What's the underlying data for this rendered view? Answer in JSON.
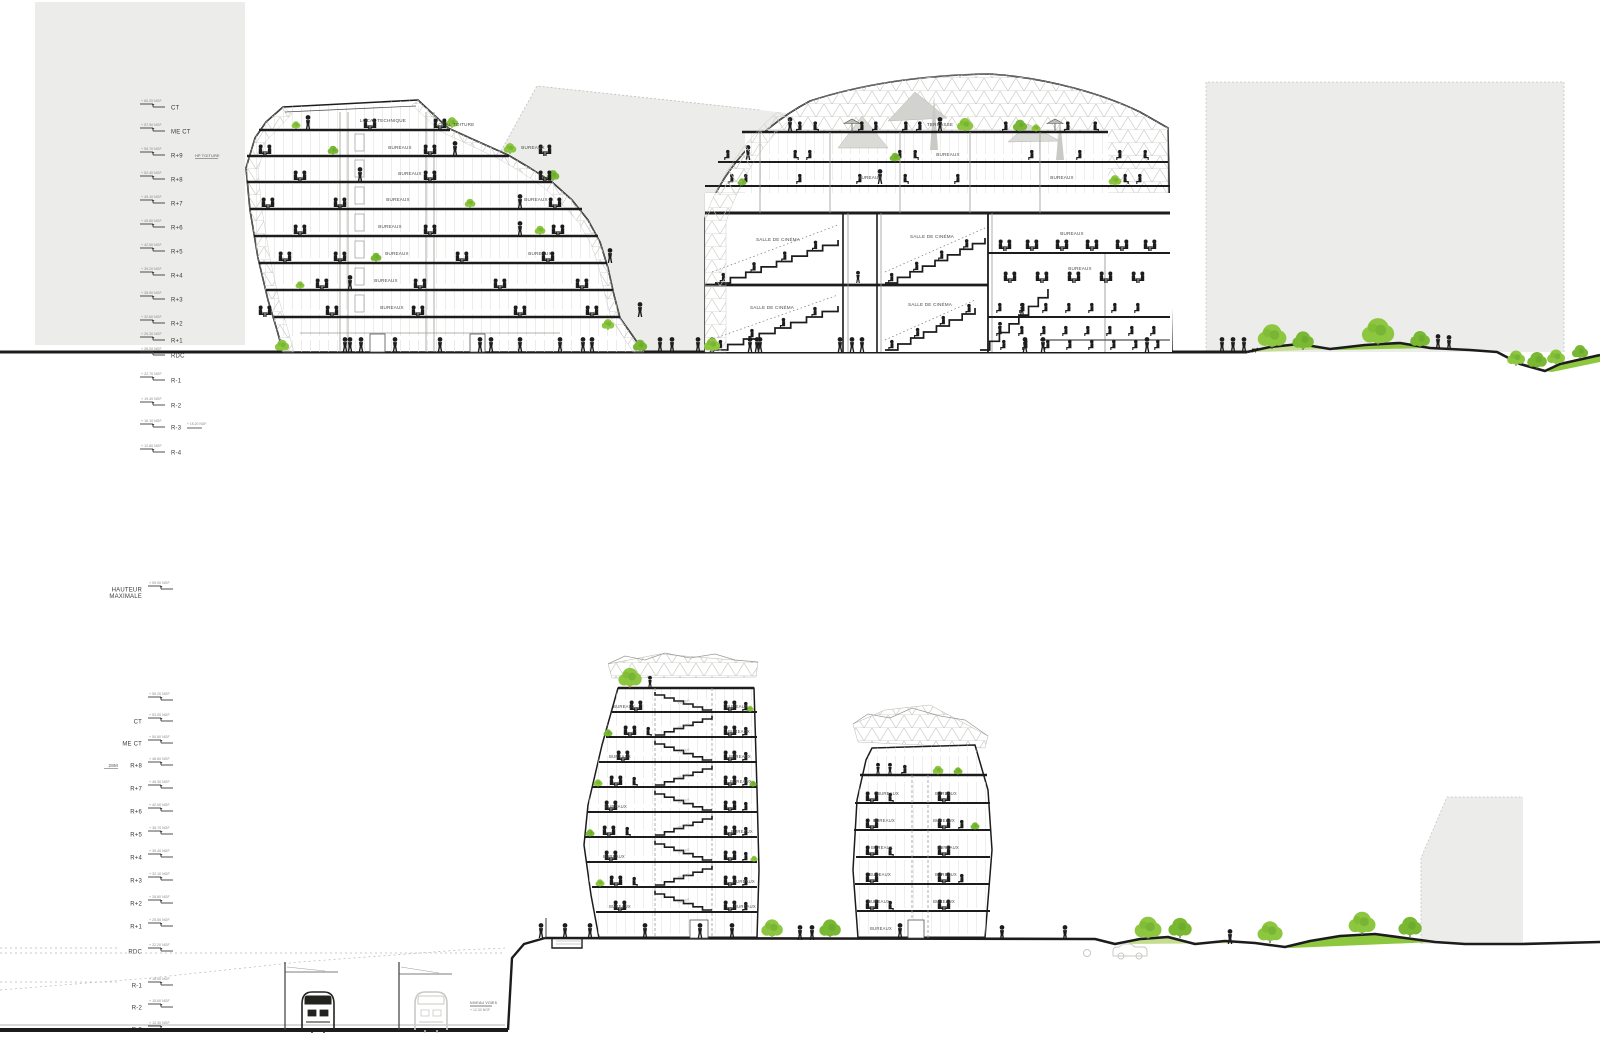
{
  "palette": {
    "ink": "#1c1c1c",
    "line_gray": "#8a8a85",
    "faint": "#c2c2be",
    "bg_block": "#ececea",
    "mesh": "#c6c6c2",
    "tree_light": "#8dc63f",
    "tree_mid": "#79b832",
    "tree_dark": "#5f9e2c",
    "grass_light": "#c4dd8f",
    "grass": "#8dc63f",
    "accent_trunk": "#c84b1e",
    "label_gray": "#4a4a45",
    "elev_gray": "#8a8a85"
  },
  "top_section": {
    "levels": [
      {
        "label": "CT",
        "elev": "+ 60.20 NGF",
        "y": 104
      },
      {
        "label": "ME CT",
        "elev": "+ 57.90 NGF",
        "y": 128
      },
      {
        "label": "R+9",
        "elev": "+ 55.70 NGF",
        "y": 152,
        "note": "HP TOITURE"
      },
      {
        "label": "R+8",
        "elev": "+ 52.40 NGF",
        "y": 176
      },
      {
        "label": "R+7",
        "elev": "+ 49.10 NGF",
        "y": 200
      },
      {
        "label": "R+6",
        "elev": "+ 45.80 NGF",
        "y": 224
      },
      {
        "label": "R+5",
        "elev": "+ 42.50 NGF",
        "y": 248
      },
      {
        "label": "R+4",
        "elev": "+ 39.20 NGF",
        "y": 272
      },
      {
        "label": "R+3",
        "elev": "+ 35.90 NGF",
        "y": 296
      },
      {
        "label": "R+2",
        "elev": "+ 32.60 NGF",
        "y": 320
      },
      {
        "label": "R+1",
        "elev": "+ 29.30 NGF",
        "y": 337
      },
      {
        "label": "RDC",
        "elev": "+ 26.00 NGF",
        "y": 352
      },
      {
        "label": "R-1",
        "elev": "+ 22.70 NGF",
        "y": 377
      },
      {
        "label": "R-2",
        "elev": "+ 19.40 NGF",
        "y": 402
      },
      {
        "label": "R-3",
        "elev": "+ 16.10 NGF",
        "y": 424,
        "note2": "+ 15.20 NGF"
      },
      {
        "label": "R-4",
        "elev": "+ 12.80 NGF",
        "y": 449
      }
    ],
    "left_building_labels": [
      {
        "t": "LOCAL TECHNIQUE",
        "x": 383,
        "y": 122
      },
      {
        "t": "LOCAL TOITURE",
        "x": 455,
        "y": 126
      },
      {
        "t": "BUREAUX",
        "x": 400,
        "y": 149
      },
      {
        "t": "BUREAUX",
        "x": 533,
        "y": 149
      },
      {
        "t": "BUREAUX",
        "x": 410,
        "y": 175
      },
      {
        "t": "BUREAUX",
        "x": 398,
        "y": 201
      },
      {
        "t": "BUREAUX",
        "x": 536,
        "y": 201
      },
      {
        "t": "BUREAUX",
        "x": 390,
        "y": 228
      },
      {
        "t": "BUREAUX",
        "x": 397,
        "y": 255
      },
      {
        "t": "BUREAUX",
        "x": 540,
        "y": 255
      },
      {
        "t": "BUREAUX",
        "x": 386,
        "y": 282
      },
      {
        "t": "BUREAUX",
        "x": 392,
        "y": 309
      }
    ],
    "right_building_labels": [
      {
        "t": "TERRASSE",
        "x": 940,
        "y": 126
      },
      {
        "t": "BUREAUX",
        "x": 948,
        "y": 156
      },
      {
        "t": "BUREAUX",
        "x": 870,
        "y": 179
      },
      {
        "t": "BUREAUX",
        "x": 1062,
        "y": 179
      },
      {
        "t": "SALLE DE CINÉMA",
        "x": 778,
        "y": 241
      },
      {
        "t": "SALLE DE CINÉMA",
        "x": 932,
        "y": 238
      },
      {
        "t": "BUREAUX",
        "x": 1072,
        "y": 235
      },
      {
        "t": "SALLE DE CINÉMA",
        "x": 772,
        "y": 309
      },
      {
        "t": "SALLE DE CINÉMA",
        "x": 930,
        "y": 306
      },
      {
        "t": "BUREAUX",
        "x": 1080,
        "y": 270
      }
    ]
  },
  "bottom_section": {
    "levels": [
      {
        "label": "HAUTEUR",
        "label2": "MAXIMALE",
        "elev": "+ 59.00 NGF",
        "y": 586
      },
      {
        "label": "",
        "elev": "+ 55.20 NGF",
        "y": 697
      },
      {
        "label": "CT",
        "elev": "+ 53.00 NGF",
        "y": 718
      },
      {
        "label": "ME CT",
        "elev": "+ 50.80 NGF",
        "y": 740
      },
      {
        "label": "R+8",
        "pre": "28M",
        "elev": "+ 48.60 NGF",
        "y": 762
      },
      {
        "label": "R+7",
        "elev": "+ 45.30 NGF",
        "y": 785
      },
      {
        "label": "R+6",
        "elev": "+ 42.00 NGF",
        "y": 808
      },
      {
        "label": "R+5",
        "elev": "+ 38.70 NGF",
        "y": 831
      },
      {
        "label": "R+4",
        "elev": "+ 35.40 NGF",
        "y": 854
      },
      {
        "label": "R+3",
        "elev": "+ 32.10 NGF",
        "y": 877
      },
      {
        "label": "R+2",
        "elev": "+ 28.80 NGF",
        "y": 900
      },
      {
        "label": "R+1",
        "elev": "+ 25.50 NGF",
        "y": 923
      },
      {
        "label": "RDC",
        "elev": "+ 22.20 NGF",
        "y": 948,
        "dash": true
      },
      {
        "label": "R-1",
        "elev": "+ 18.90 NGF",
        "y": 982,
        "dash": true
      },
      {
        "label": "R-2",
        "elev": "+ 15.60 NGF",
        "y": 1004
      },
      {
        "label": "R-3",
        "elev": "+ 12.30 NGF",
        "y": 1026
      }
    ],
    "shaft_label": "PALIER",
    "rail_label": {
      "line1": "NIVEAU VOIES",
      "line2": "+ 12.30 NGF"
    },
    "tower1_labels": [
      {
        "t": "BUREAUX",
        "x": 624,
        "y": 708
      },
      {
        "t": "BUREAUX",
        "x": 620,
        "y": 758
      },
      {
        "t": "BUREAUX",
        "x": 616,
        "y": 808
      },
      {
        "t": "BUREAUX",
        "x": 614,
        "y": 858
      },
      {
        "t": "BUREAUX",
        "x": 620,
        "y": 908
      },
      {
        "t": "BUREAUX",
        "x": 737,
        "y": 708
      },
      {
        "t": "BUREAUX",
        "x": 739,
        "y": 733
      },
      {
        "t": "BUREAUX",
        "x": 740,
        "y": 758
      },
      {
        "t": "BUREAUX",
        "x": 741,
        "y": 783
      },
      {
        "t": "BUREAUX",
        "x": 742,
        "y": 833
      },
      {
        "t": "BUREAUX",
        "x": 744,
        "y": 883
      },
      {
        "t": "BUREAUX",
        "x": 745,
        "y": 908
      }
    ],
    "tower2_labels": [
      {
        "t": "BUREAUX",
        "x": 888,
        "y": 795
      },
      {
        "t": "BUREAUX",
        "x": 884,
        "y": 822
      },
      {
        "t": "BUREAUX",
        "x": 882,
        "y": 849
      },
      {
        "t": "BUREAUX",
        "x": 880,
        "y": 876
      },
      {
        "t": "BUREAUX",
        "x": 879,
        "y": 903
      },
      {
        "t": "BUREAUX",
        "x": 881,
        "y": 930
      },
      {
        "t": "BUREAUX",
        "x": 946,
        "y": 795
      },
      {
        "t": "BUREAUX",
        "x": 944,
        "y": 822
      },
      {
        "t": "BUREAUX",
        "x": 948,
        "y": 849
      },
      {
        "t": "BUREAUX",
        "x": 946,
        "y": 876
      },
      {
        "t": "BUREAUX",
        "x": 944,
        "y": 903
      }
    ]
  }
}
